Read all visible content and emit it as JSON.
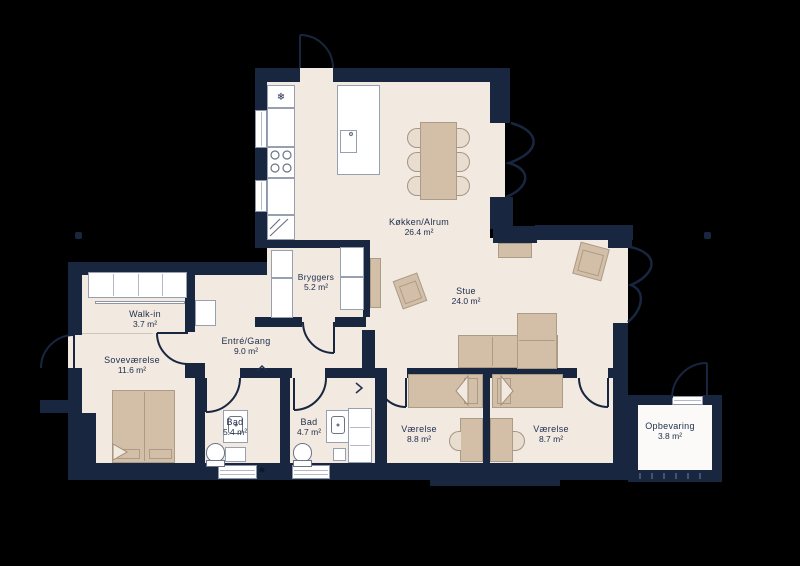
{
  "floorplan": {
    "colors": {
      "background": "#000000",
      "wall": "#182640",
      "floor": "#f2e9e1",
      "furniture": "#d3bfa8",
      "fixture": "#ffffff",
      "storage_floor": "#fbfaf8",
      "label_text": "#22304e"
    },
    "freezer_icon": "❄",
    "rooms": [
      {
        "name": "Køkken/Alrum",
        "area": "26.4 m²"
      },
      {
        "name": "Stue",
        "area": "24.0 m²"
      },
      {
        "name": "Bryggers",
        "area": "5.2 m²"
      },
      {
        "name": "Walk-in",
        "area": "3.7 m²"
      },
      {
        "name": "Soveværelse",
        "area": "11.6 m²"
      },
      {
        "name": "Entré/Gang",
        "area": "9.0 m²"
      },
      {
        "name": "Bad",
        "area": "5.4 m²"
      },
      {
        "name": "Bad",
        "area": "4.7 m²"
      },
      {
        "name": "Værelse",
        "area": "8.8 m²"
      },
      {
        "name": "Værelse",
        "area": "8.7 m²"
      },
      {
        "name": "Opbevaring",
        "area": "3.8 m²"
      }
    ]
  }
}
